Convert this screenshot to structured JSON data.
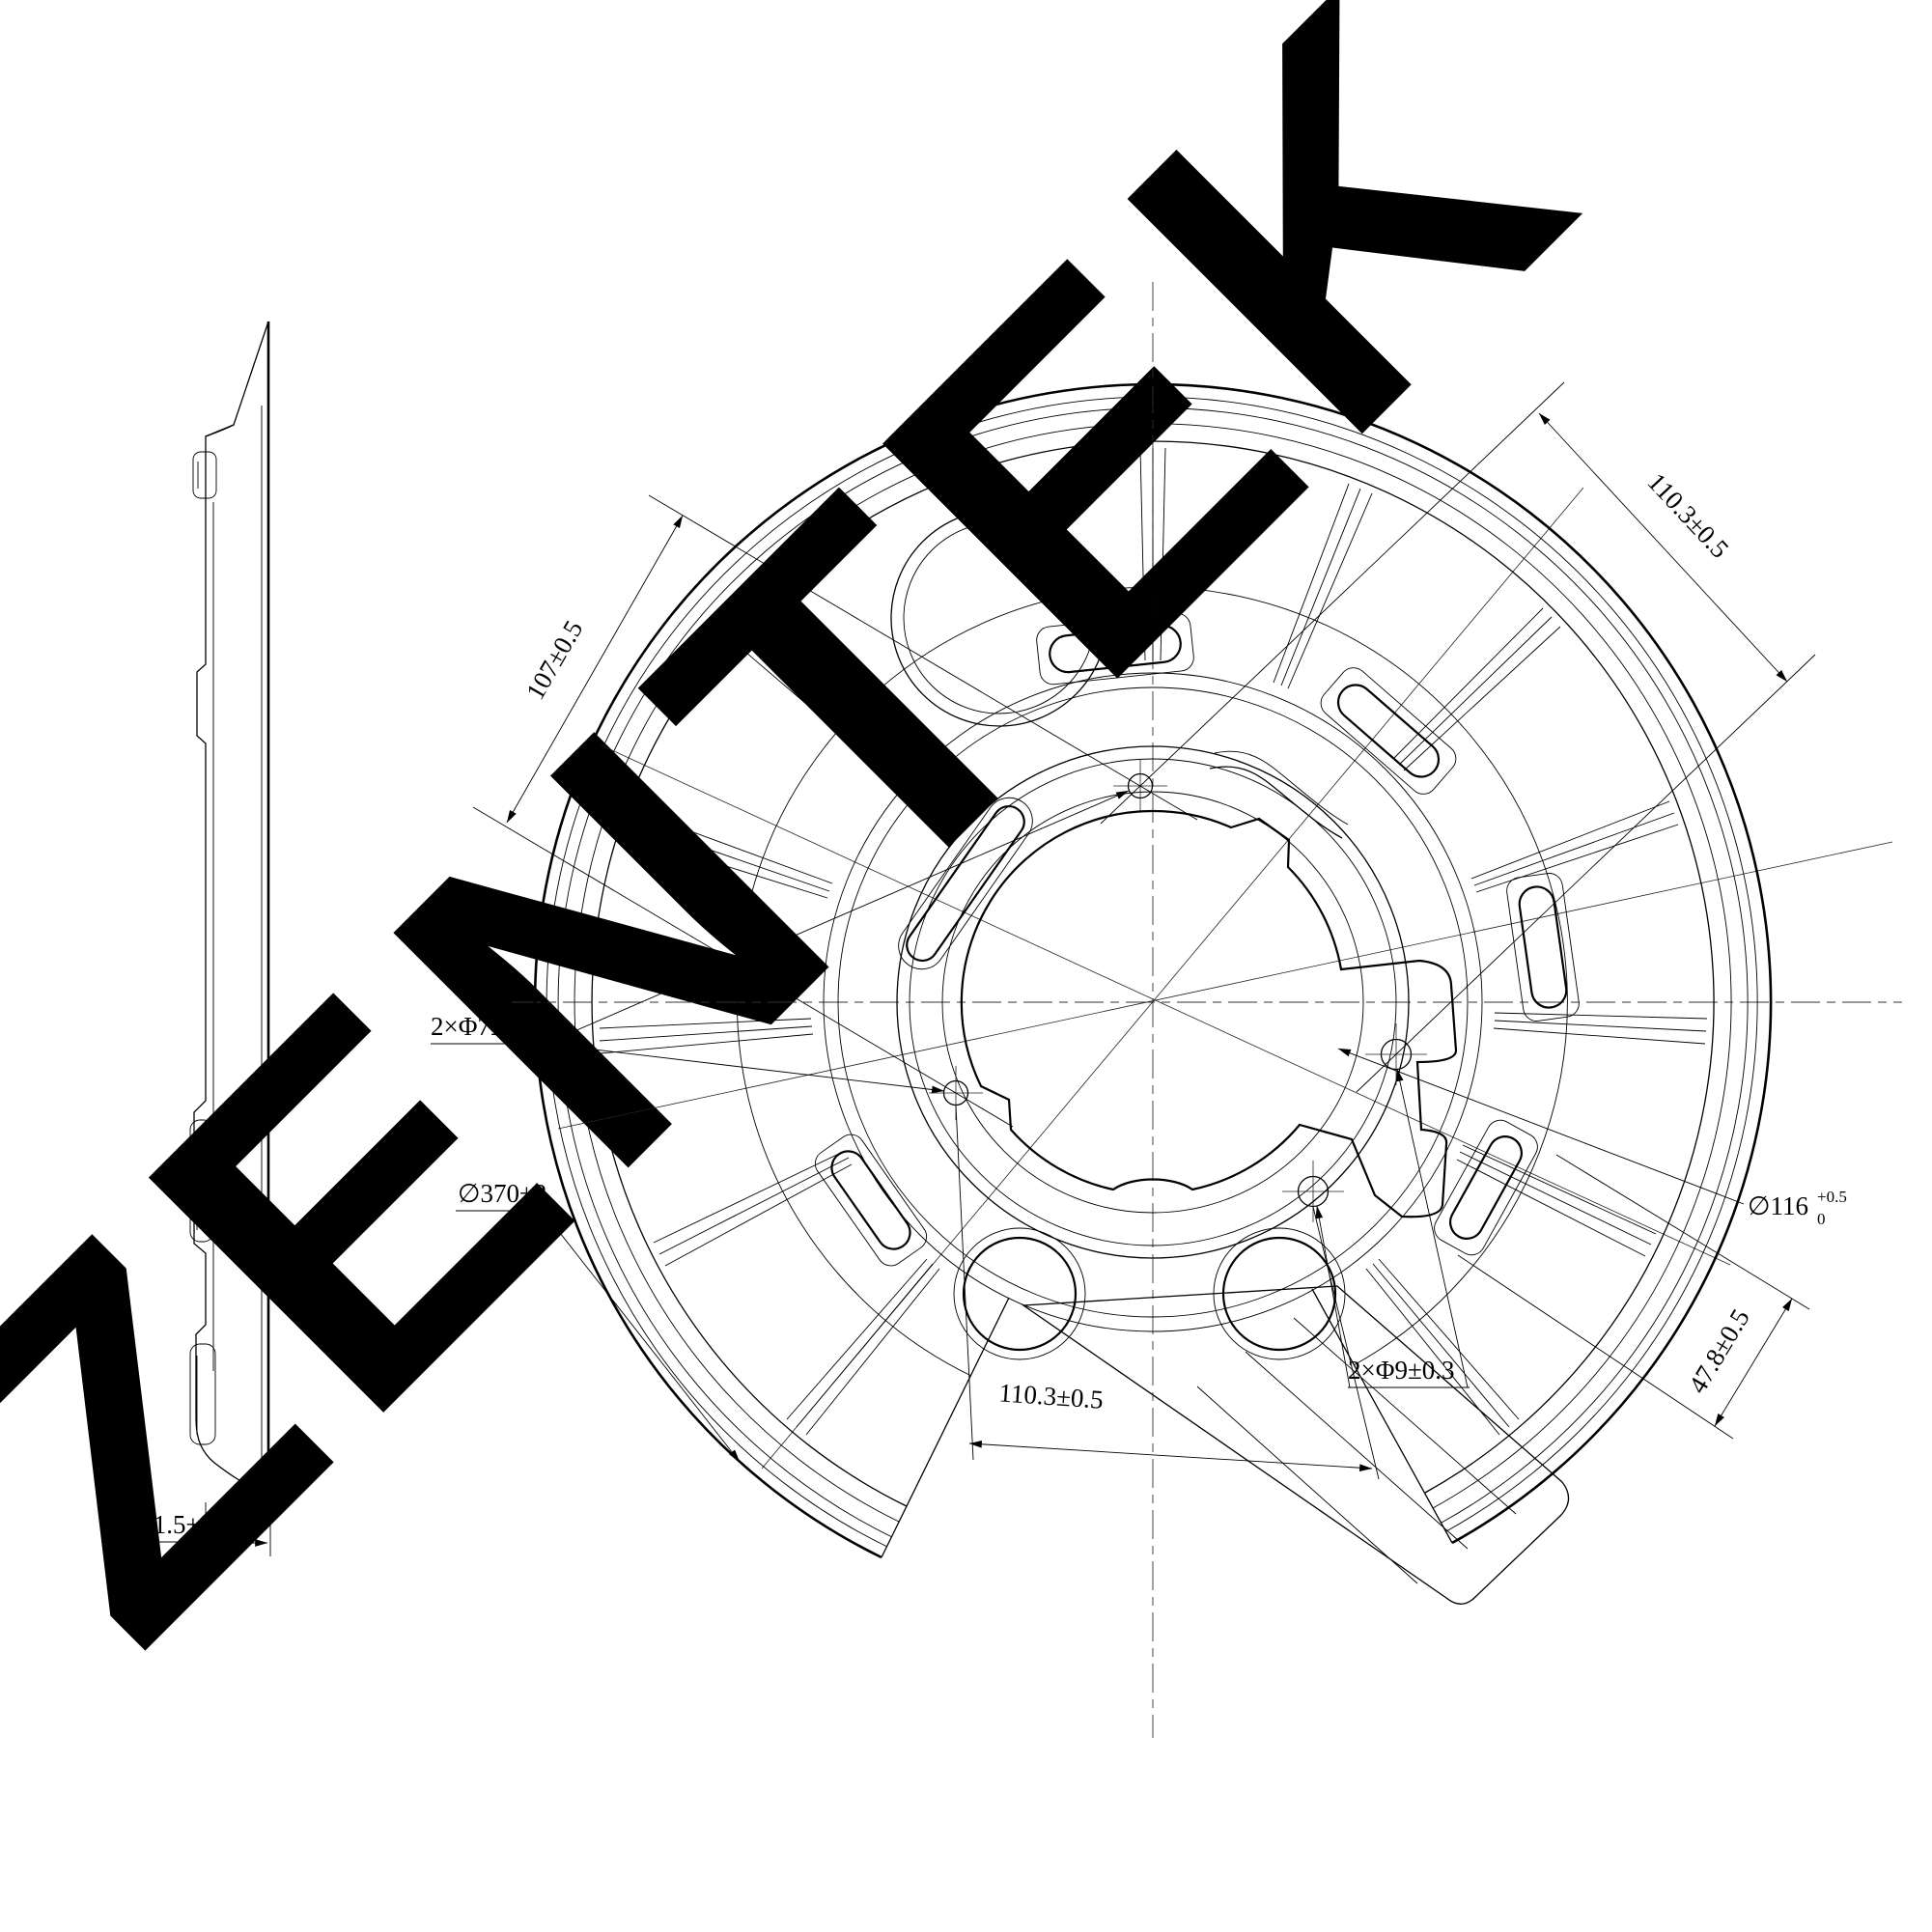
{
  "page": {
    "background": "#ffffff",
    "line_color": "#000000"
  },
  "watermark": {
    "text": "ZENTEK",
    "color": "#efc0b8"
  },
  "dimensions": {
    "hole_spacing_left": {
      "label": "107±0.5"
    },
    "hole_spacing_top_right": {
      "label": "110.3±0.5"
    },
    "small_holes": {
      "label": "2×Φ7±0.2"
    },
    "outer_diameter": {
      "label": "∅370±2"
    },
    "center_bore": {
      "label": "∅116",
      "tol_upper": "+0.5",
      "tol_lower": "0"
    },
    "flange_offset": {
      "label": "47.8±0.5"
    },
    "large_holes": {
      "label": "2×Φ9±0.3"
    },
    "hole_spacing_bottom": {
      "label": "110.3±0.5"
    },
    "thickness": {
      "label": "21.5±2"
    }
  }
}
